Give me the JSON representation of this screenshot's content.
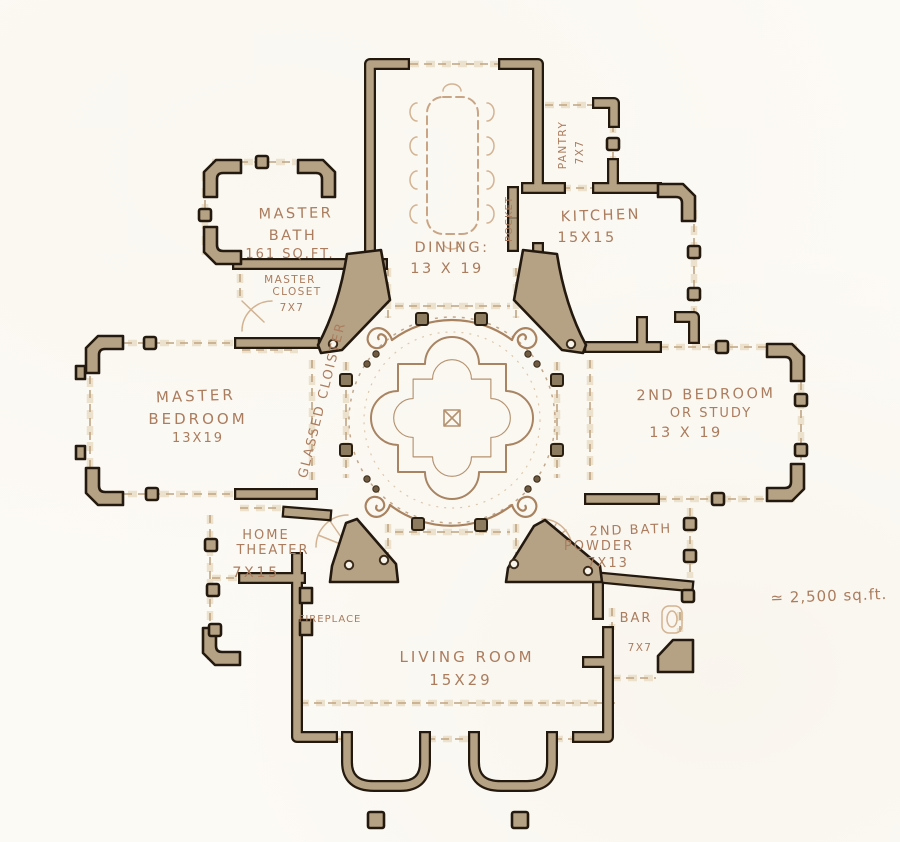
{
  "drawing": {
    "type": "hand-drawn residential floor plan",
    "total_area_note": "≃ 2,500 sq.ft."
  },
  "colors": {
    "paper": "#fcfaf5",
    "wall_fill": "#b5a285",
    "ink": "#24190e",
    "sketch": "#c9a585",
    "handwriting": "#ab7c5d"
  },
  "rooms": {
    "master_bath": {
      "line1": "MASTER",
      "line2": "BATH",
      "size": "161 SQ.FT."
    },
    "master_closet": {
      "line1": "MASTER",
      "line2": "CLOSET",
      "size": "7X7"
    },
    "dining": {
      "name": "DINING:",
      "size": "13 X 19"
    },
    "pantry": {
      "name": "PANTRY",
      "size": "7X7"
    },
    "kitchen": {
      "name": "KITCHEN",
      "size": "15X15"
    },
    "master_bedroom": {
      "line1": "MASTER",
      "line2": "BEDROOM",
      "size": "13X19"
    },
    "second_bedroom": {
      "line1": "2ND BEDROOM",
      "line2": "OR STUDY",
      "size": "13 X 19"
    },
    "cloister": {
      "name": "GLASSED CLOISTER"
    },
    "home_theater": {
      "line1": "HOME",
      "line2": "THEATER",
      "size": "7X15"
    },
    "second_bath": {
      "line1": "2ND BATH",
      "line2": "POWDER",
      "size": "7X13"
    },
    "bar": {
      "name": "BAR",
      "size": "7X7"
    },
    "living_room": {
      "name": "LIVING ROOM",
      "size": "15X29"
    }
  },
  "features": {
    "fireplace": "FIREPLACE",
    "pocket_door": "POCKET"
  }
}
